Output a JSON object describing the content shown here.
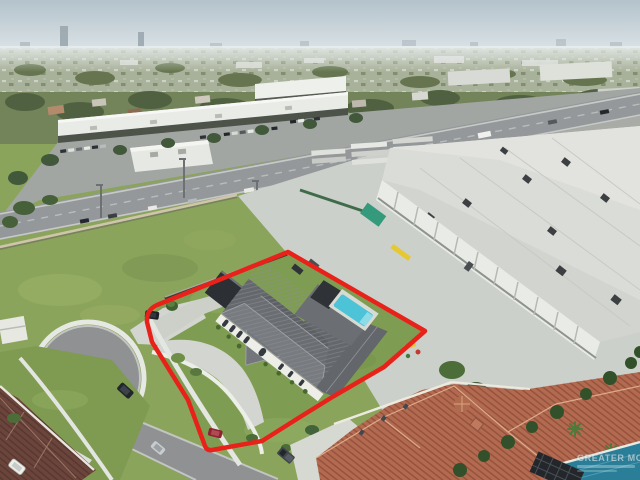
{
  "photo": {
    "kind": "aerial-drone-real-estate-photo",
    "width_px": 640,
    "height_px": 480
  },
  "watermark": {
    "line1": "GREATER MCALLEN",
    "color": "rgba(255,255,255,0.52)"
  },
  "annotations": {
    "property_boundary_color": "#e8221a",
    "property_boundary_width": 4.5
  },
  "palette": {
    "sky_top": "#b3c2cb",
    "sky_horizon": "#e4eaec",
    "distant_band": "#a8b199",
    "tree_green": "#5a6b44",
    "field_grass": "#8ba45c",
    "lawn_grass": "#7f9d52",
    "asphalt": "#94989a",
    "street": "#8f9193",
    "concrete": "#ccd0ca",
    "sidewalk": "#e7e9e3",
    "warehouse_roof": "#dadcd7",
    "warehouse_wall": "#e9ebe6",
    "house_roof_dark": "#64676b",
    "pool_turquoise": "#4cc3d7",
    "neighbor_pool": "#2a7e98",
    "terracotta_roof": "#b26a50",
    "maroon_roof": "#6b453c",
    "hedge_green": "#3c5a31"
  }
}
